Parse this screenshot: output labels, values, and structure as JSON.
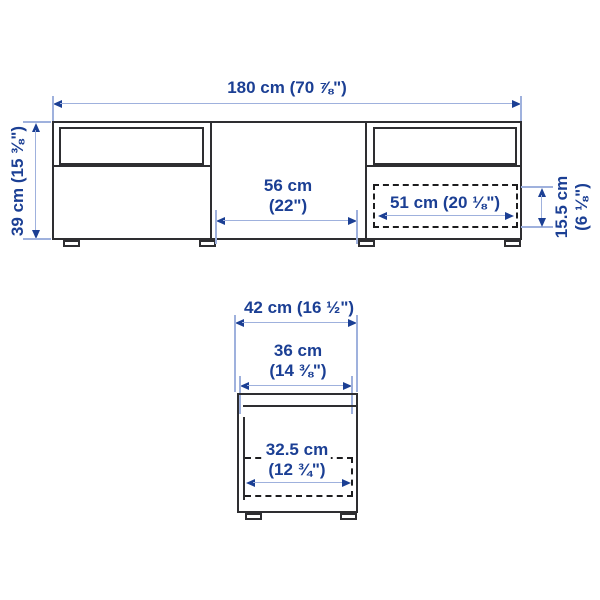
{
  "colors": {
    "dimension_text": "#1b3f94",
    "arrow_head": "#1b3f94",
    "extension_line": "#9fb1dd",
    "structure_line": "#2e2e31",
    "background": "#ffffff"
  },
  "front_view": {
    "overall_width": "180 cm (70 ⅞\")",
    "overall_height": "39 cm (15 ⅜\")",
    "middle_width_cm": "56 cm",
    "middle_width_in": "(22\")",
    "drawer_width": "51 cm (20 ⅛\")",
    "drawer_height_cm": "15.5 cm",
    "drawer_height_in": "(6 ⅛\")"
  },
  "side_view": {
    "overall_depth": "42 cm (16 ½\")",
    "top_depth_cm": "36 cm",
    "top_depth_in": "(14 ⅜\")",
    "drawer_depth_cm": "32.5 cm",
    "drawer_depth_in": "(12 ¾\")"
  }
}
